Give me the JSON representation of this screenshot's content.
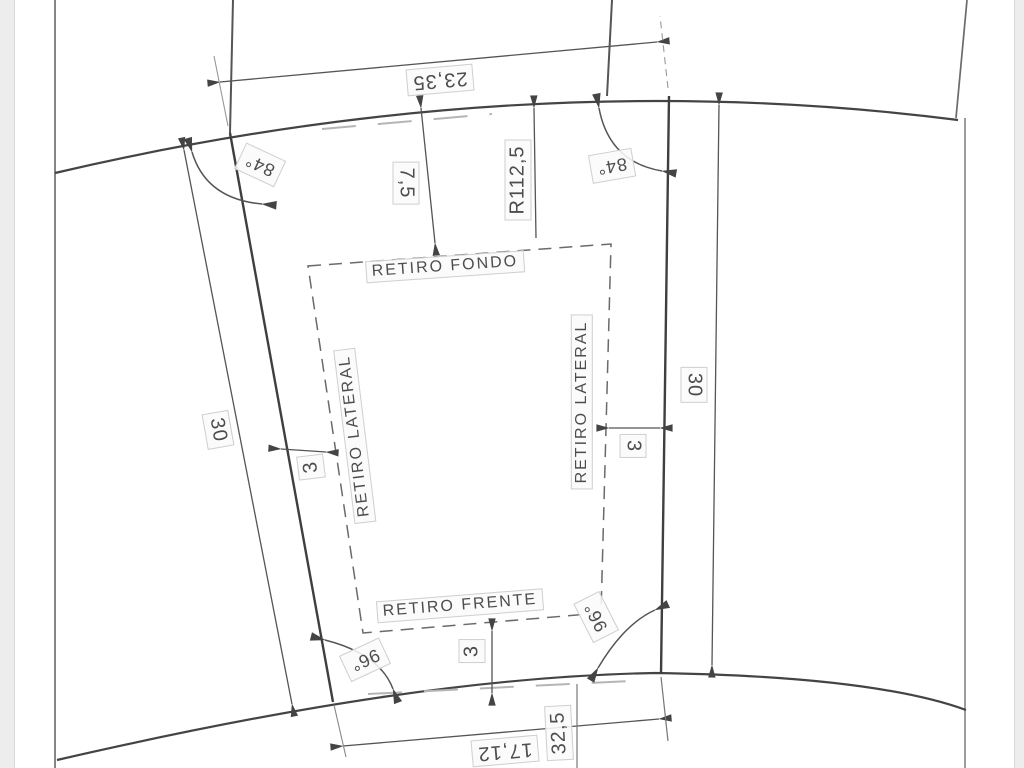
{
  "drawing": {
    "setbacks": {
      "rear": "RETIRO FONDO",
      "left": "RETIRO LATERAL",
      "right": "RETIRO LATERAL",
      "front": "RETIRO FRENTE"
    },
    "dimensions": {
      "rear_width": "23,35",
      "rear_setback_depth": "7,5",
      "rear_curve_radius": "R112,5",
      "left_side_length": "30",
      "right_side_length": "30",
      "left_setback": "3",
      "right_setback": "3",
      "front_setback": "3",
      "front_segment": "17,12",
      "front_width": "32,5"
    },
    "angles": {
      "top_left": "84°",
      "top_right": "84°",
      "bottom_left": "96°",
      "bottom_right": "96°"
    },
    "colors": {
      "line_dark": "#3f3f3f",
      "line_mid": "#666666",
      "line_faint": "#b5b5b5",
      "label_text": "#4d4d4d"
    }
  }
}
